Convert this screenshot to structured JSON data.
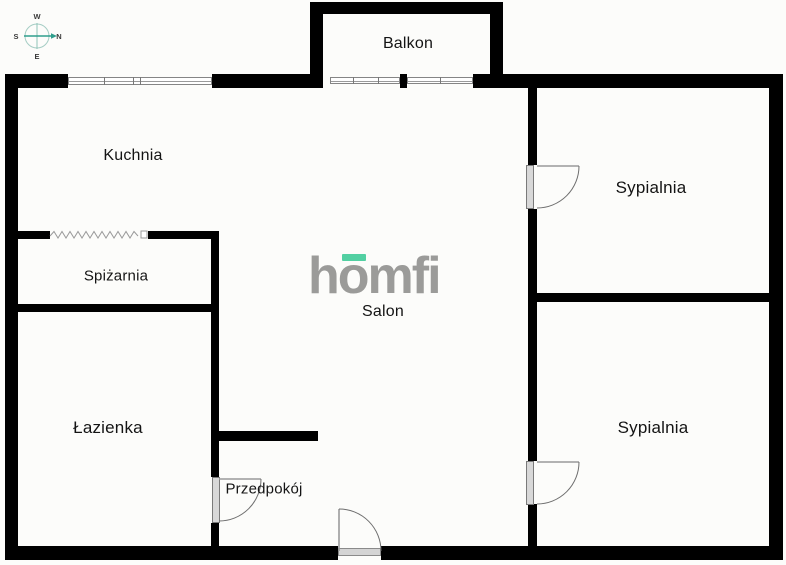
{
  "plan": {
    "rooms": [
      {
        "label": "Balkon"
      },
      {
        "label": "Kuchnia"
      },
      {
        "label": "Spiżarnia"
      },
      {
        "label": "Łazienka"
      },
      {
        "label": "Przedpokój"
      },
      {
        "label": "Salon"
      },
      {
        "label": "Sypialnia"
      },
      {
        "label": "Sypialnia"
      }
    ]
  },
  "compass": {
    "west": "W",
    "north": "N",
    "south": "S",
    "east": "E"
  },
  "watermark": {
    "text": "homfi",
    "part_h": "h",
    "part_o": "o",
    "part_mfi": "mfi"
  },
  "colors": {
    "wall": "#000000",
    "watermark_gray": "#9b9b99",
    "accent_mint": "#52d0a2",
    "compass_teal": "#2f9e8c",
    "window_stroke": "#858585",
    "door_stroke": "#6e6e6e",
    "door_fill": "#d8d8d8"
  }
}
